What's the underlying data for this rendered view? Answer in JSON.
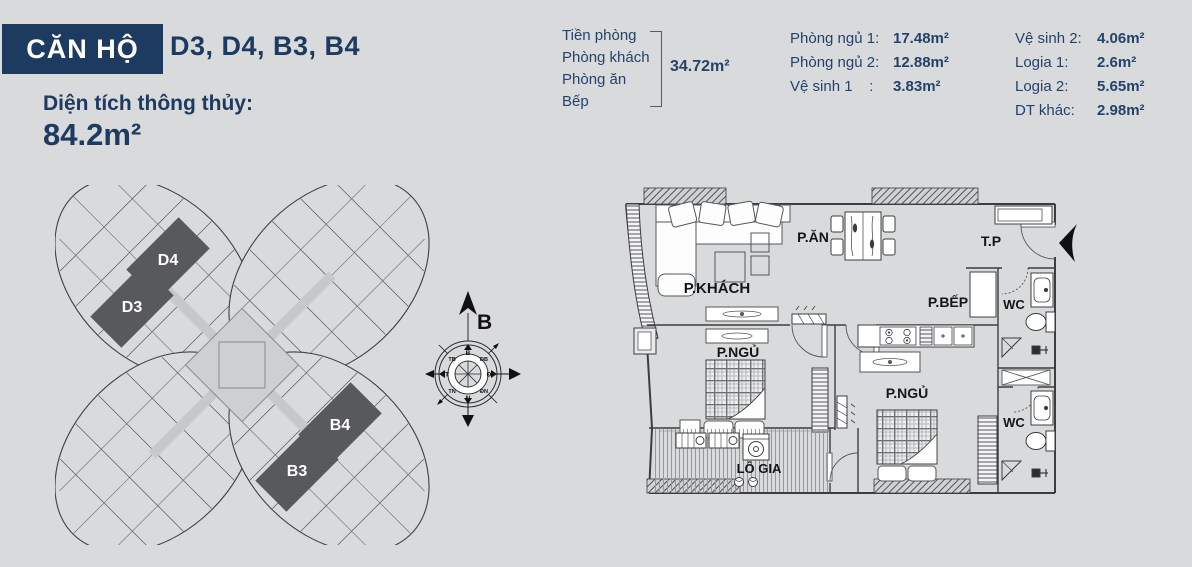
{
  "colors": {
    "background": "#d8dadc",
    "navy": "#1d3a60",
    "unit_dark": "#58595c",
    "corridor": "#c6c8ca",
    "core": "#cdcfd1",
    "plan_line": "#3b3d3f"
  },
  "header": {
    "badge": "CĂN HỘ",
    "unit_list": "D3, D4, B3, B4",
    "area_label": "Diện tích thông thủy:",
    "area_value": "84.2m²"
  },
  "areas": {
    "group": {
      "rooms": [
        "Tiền phòng",
        "Phòng khách",
        "Phòng ăn",
        "Bếp"
      ],
      "total": "34.72m²"
    },
    "col2": [
      {
        "label": "Phòng ngủ 1:",
        "value": "17.48m²"
      },
      {
        "label": "Phòng ngủ 2:",
        "value": "12.88m²"
      },
      {
        "label": "Vệ sinh 1    :",
        "value": "3.83m²"
      }
    ],
    "col3": [
      {
        "label": "Vệ sinh 2:",
        "value": "4.06m²"
      },
      {
        "label": "Logia 1:",
        "value": "2.6m²"
      },
      {
        "label": "Logia 2:",
        "value": "5.65m²"
      },
      {
        "label": "DT khác:",
        "value": "2.98m²"
      }
    ]
  },
  "site_diagram": {
    "units": [
      "D4",
      "D3",
      "B4",
      "B3"
    ]
  },
  "compass": {
    "north": "B",
    "directions": [
      "B",
      "ĐB",
      "Đ",
      "ĐN",
      "N",
      "TN",
      "T",
      "TB"
    ]
  },
  "floor_plan": {
    "rooms": [
      "P.KHÁCH",
      "P.ĂN",
      "T.P",
      "P.BẾP",
      "WC",
      "P.NGỦ",
      "P.NGỦ",
      "WC",
      "LÔ GIA"
    ]
  }
}
